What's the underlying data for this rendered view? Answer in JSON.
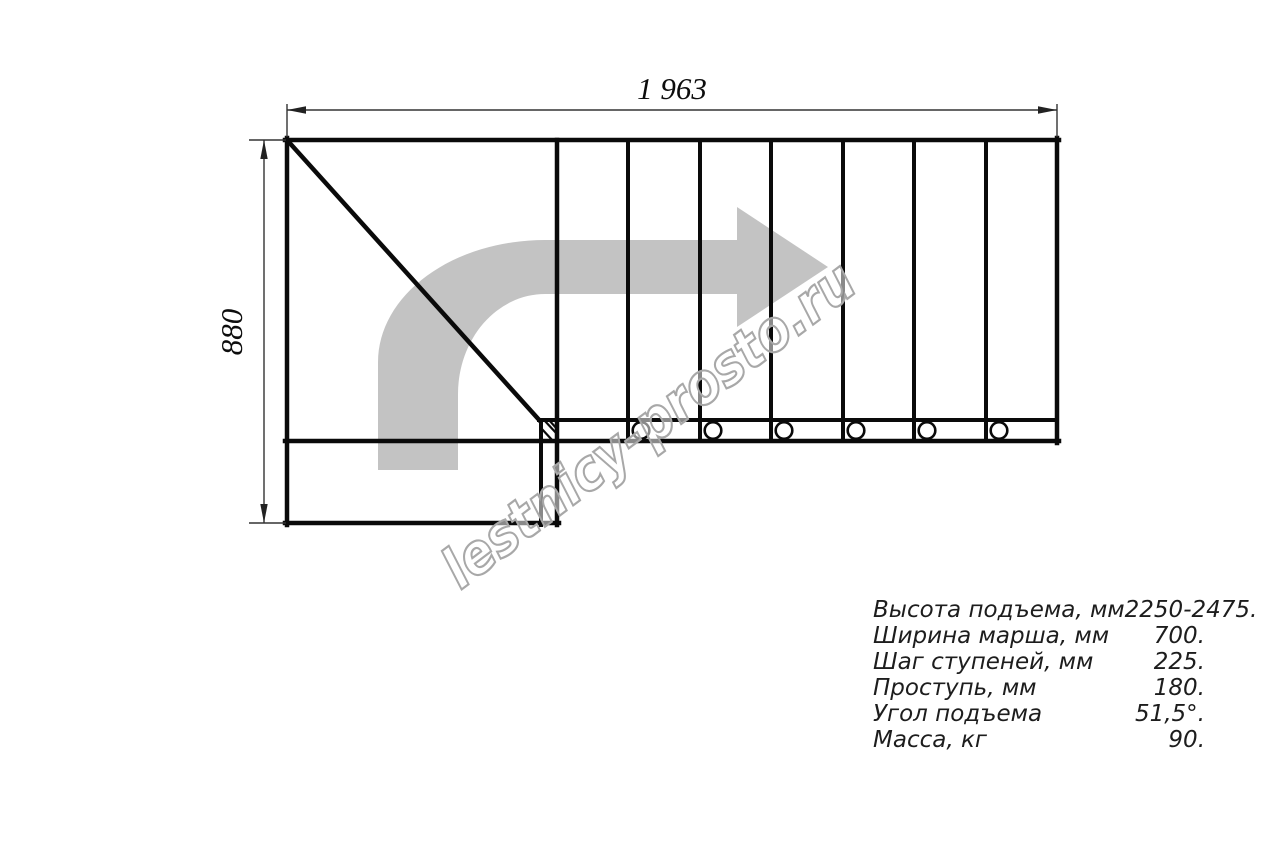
{
  "dimensions": {
    "width_label": "1 963",
    "height_label": "880"
  },
  "watermark": {
    "text": "lestnicy-prosto.ru"
  },
  "specs": {
    "rows": [
      {
        "label": "Высота подъема, мм",
        "value": "2250-2475."
      },
      {
        "label": "Ширина марша, мм",
        "value": "700."
      },
      {
        "label": "Шаг ступеней, мм",
        "value": "225."
      },
      {
        "label": "Проступь, мм",
        "value": "180."
      },
      {
        "label": "Угол подъема",
        "value": "51,5°."
      },
      {
        "label": "Масса, кг",
        "value": "90."
      }
    ]
  },
  "drawing": {
    "step_columns": 7,
    "fastener_circles": 6
  },
  "colors": {
    "line": "#0a0a0a",
    "thin_line": "#333333",
    "arrow_gray": "#c3c3c3",
    "watermark_outline": "#a8a8a8"
  }
}
